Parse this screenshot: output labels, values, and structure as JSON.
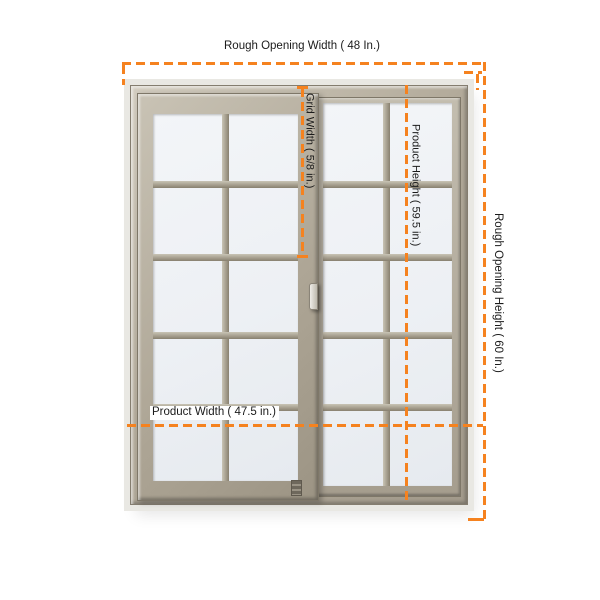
{
  "figure": {
    "description": "Sliding window product dimension diagram",
    "window_type": "horizontal sliding window, two sashes",
    "panels": 2,
    "grid_cols_per_panel": 2,
    "grid_rows": 5
  },
  "annotations": {
    "rough_opening_width": "Rough Opening Width ( 48 In.)",
    "rough_opening_height": "Rough Opening Height ( 60 In.)",
    "product_height": "Product Height ( 59.5 in.)",
    "product_width": "Product Width ( 47.5 in.)",
    "grid_width": "Grid Width ( 5/8 in.)"
  },
  "dimensions": {
    "rough_opening_width_in": 48,
    "rough_opening_height_in": 60,
    "product_width_in": 47.5,
    "product_height_in": 59.5,
    "grid_width_in": "5/8"
  },
  "colors": {
    "dimension_line": "#F5821F",
    "frame": "#b2aa9a",
    "frame_light": "#d2ccbf",
    "frame_dark": "#8a8273",
    "glass": "#edf0f4",
    "text": "#1b1b1b",
    "background": "#ffffff"
  }
}
